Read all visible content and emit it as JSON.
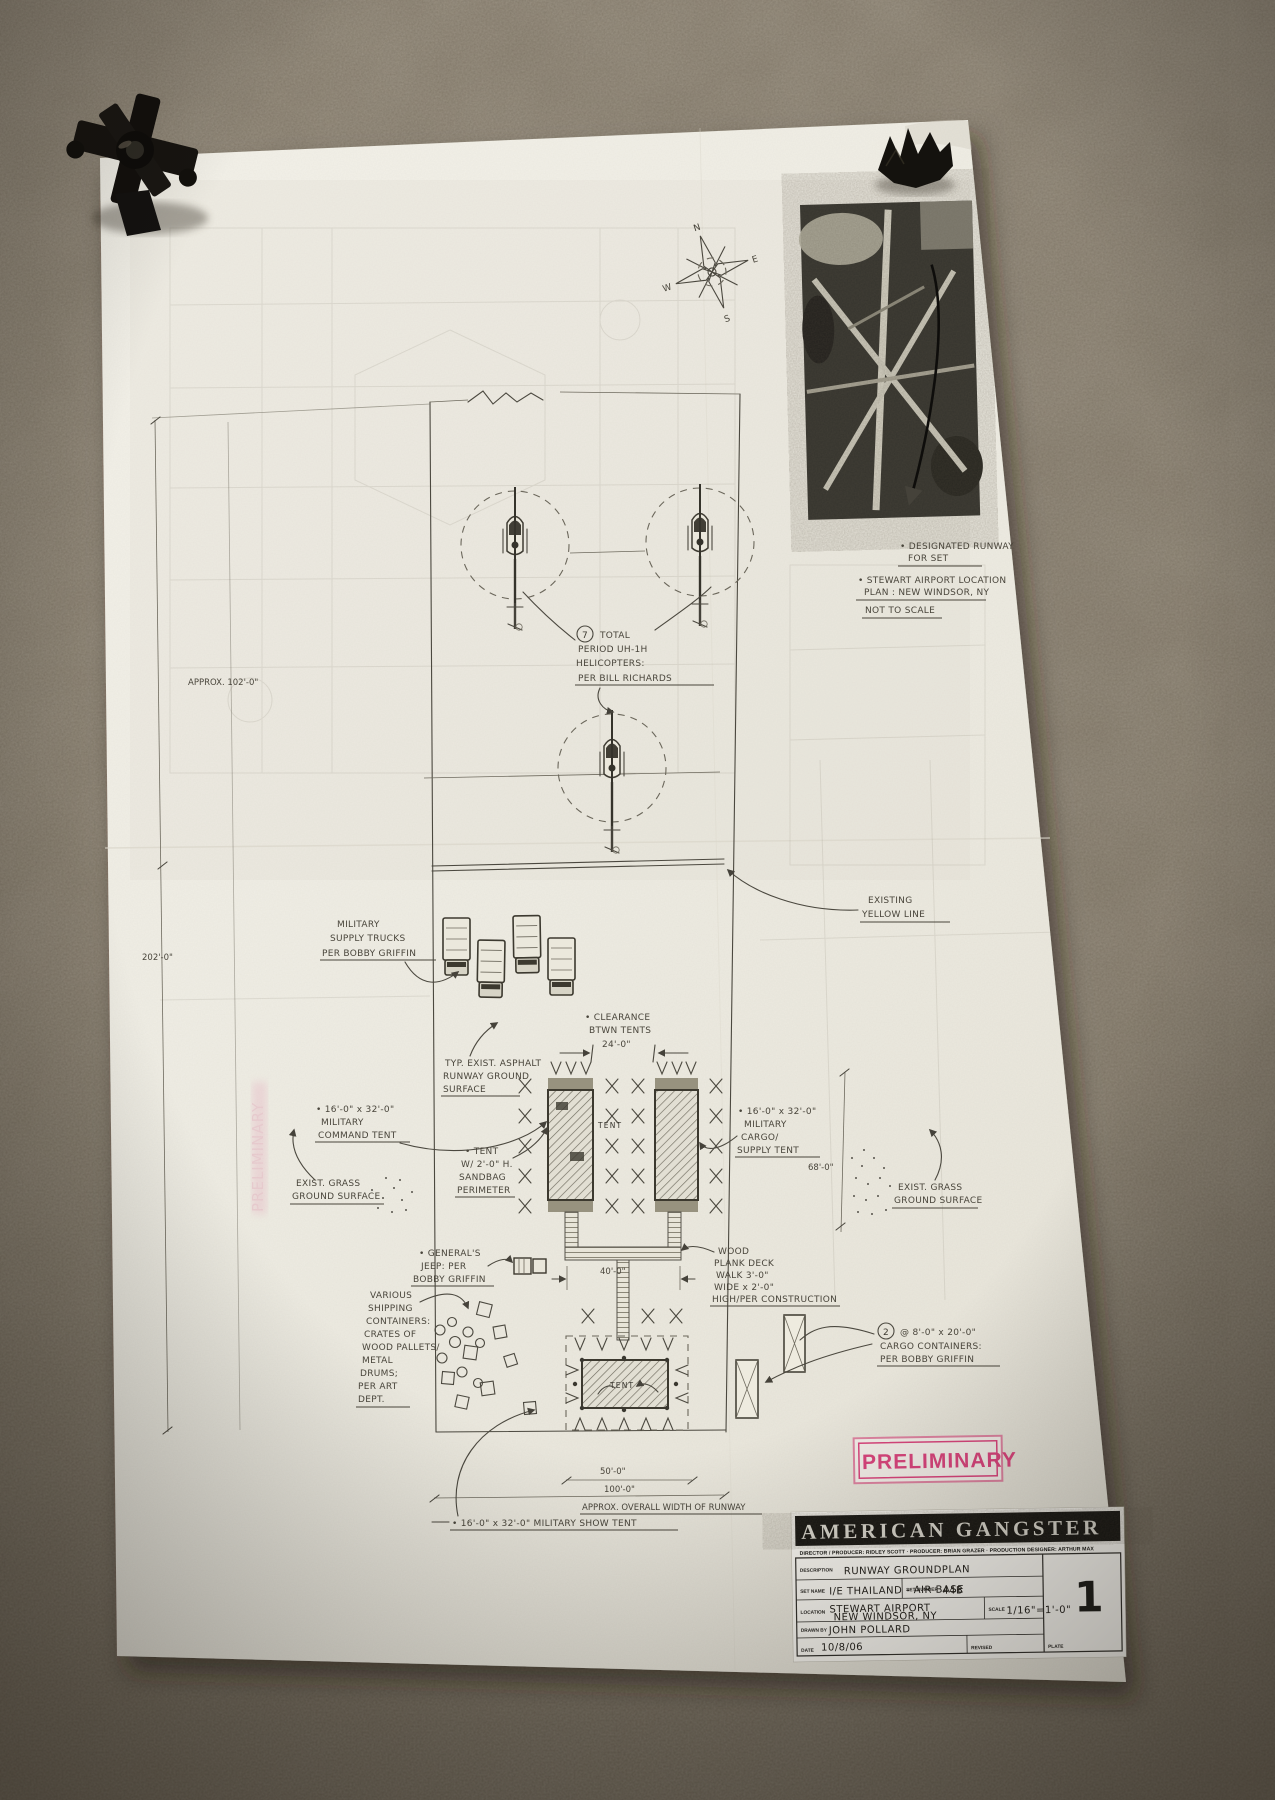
{
  "stamp": {
    "text": "PRELIMINARY",
    "color": "#d8457c"
  },
  "ghost_stamp": "PRELIMINARY",
  "compass": {
    "n": "N",
    "e": "E",
    "s": "S",
    "w": "W"
  },
  "photo_area": {
    "note_designated": [
      "• DESIGNATED RUNWAY",
      "FOR SET"
    ],
    "note_location": [
      "• STEWART AIRPORT LOCATION",
      "PLAN : NEW WINDSOR, NY",
      "NOT TO SCALE"
    ]
  },
  "notes": {
    "heli_count": "7",
    "heli": [
      "TOTAL",
      "PERIOD UH-1H",
      "HELICOPTERS:",
      "PER BILL RICHARDS"
    ],
    "trucks": [
      "MILITARY",
      "SUPPLY TRUCKS",
      "PER BOBBY GRIFFIN"
    ],
    "yellow_line": [
      "EXISTING",
      "YELLOW LINE"
    ],
    "clearance": [
      "• CLEARANCE",
      "BTWN TENTS",
      "24'-0\""
    ],
    "asphalt": [
      "TYP. EXIST. ASPHALT",
      "RUNWAY GROUND",
      "SURFACE"
    ],
    "command_tent": [
      "• 16'-0\" x 32'-0\"",
      "MILITARY",
      "COMMAND TENT"
    ],
    "sandbag": [
      "• TENT",
      "W/ 2'-0\" H.",
      "SANDBAG",
      "PERIMETER"
    ],
    "cargo_tent": [
      "• 16'-0\" x 32'-0\"",
      "MILITARY",
      "CARGO/",
      "SUPPLY TENT"
    ],
    "grass_left": [
      "EXIST. GRASS",
      "GROUND SURFACE"
    ],
    "grass_right": [
      "EXIST. GRASS",
      "GROUND SURFACE"
    ],
    "jeep": [
      "• GENERAL'S",
      "JEEP: PER",
      "BOBBY GRIFFIN"
    ],
    "plank": [
      "WOOD",
      "PLANK DECK",
      "WALK 3'-0\"",
      "WIDE x 2'-0\"",
      "HIGH/PER CONSTRUCTION"
    ],
    "containers": [
      "VARIOUS",
      "SHIPPING",
      "CONTAINERS:",
      "CRATES OF",
      "WOOD PALLETS/",
      "METAL",
      "DRUMS;",
      "PER ART",
      "DEPT."
    ],
    "cargo_count": "2",
    "cargo_containers": [
      "@ 8'-0\" x 20'-0\"",
      "CARGO CONTAINERS:",
      "PER BOBBY GRIFFIN"
    ],
    "show_tent": "• 16'-0\" x 32'-0\" MILITARY SHOW TENT",
    "tent_label": "TENT",
    "tent_label2": "TENT"
  },
  "dims": {
    "approx102": "APPROX. 102'-0\"",
    "d202": "202'-0\"",
    "d68": "68'-0\"",
    "d40": "40'-0\"",
    "d50": "50'-0\"",
    "d100": "100'-0\"",
    "overall": "APPROX. OVERALL WIDTH OF RUNWAY"
  },
  "titleblock": {
    "title": "AMERICAN GANGSTER",
    "credits": "DIRECTOR / PRODUCER: RIDLEY SCOTT   ·   PRODUCER: BRIAN GRAZER   ·   PRODUCTION DESIGNER: ARTHUR MAX",
    "description_label": "DESCRIPTION",
    "description": "RUNWAY GROUNDPLAN",
    "set_name_label": "SET NAME",
    "set_name": "I/E THAILAND - AIR BASE",
    "set_number_label": "SET NUMBER",
    "set_number": "44B",
    "location_label": "LOCATION",
    "location1": "STEWART AIRPORT",
    "location2": "NEW WINDSOR, NY",
    "scale_label": "SCALE",
    "scale": "1/16\"=1'-0\"",
    "drawn_by_label": "DRAWN BY",
    "drawn_by": "JOHN POLLARD",
    "date_label": "DATE",
    "date": "10/8/06",
    "revised_label": "REVISED",
    "plate_label": "PLATE",
    "plate": "1"
  }
}
